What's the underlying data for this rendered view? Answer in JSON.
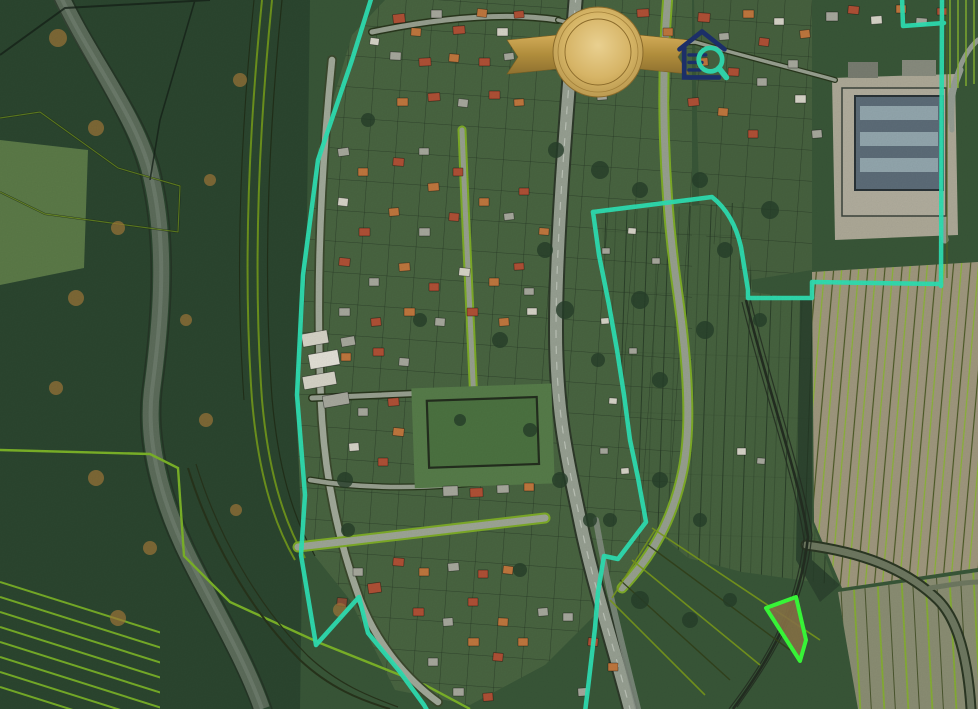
{
  "map": {
    "copyright_watermark": "© GKÚ, NLC",
    "district_label": "k.ú. Haniska",
    "district_label_color": "#cf57a1",
    "boundary_color": "#2fe3b5",
    "highlight_color": "#3aff3a",
    "parcel_line_bright": "#7db529",
    "parcel_line_dark": "#3a481c"
  },
  "badge": {
    "arc_top": "ZDRUŽENIE REALITNÝCH",
    "stars": "★ ★ ★",
    "title": "OVERENÝ",
    "subtitle": "ČLEN",
    "arc_bottom": "KANCELÁRIÍ SLOVENSKA",
    "gold": "#d3b264"
  },
  "logo": {
    "brand": "ZoznamRealit",
    "separator": ".",
    "tld": "sk",
    "navy": "#1c2f68",
    "teal": "#2fd0a8"
  }
}
